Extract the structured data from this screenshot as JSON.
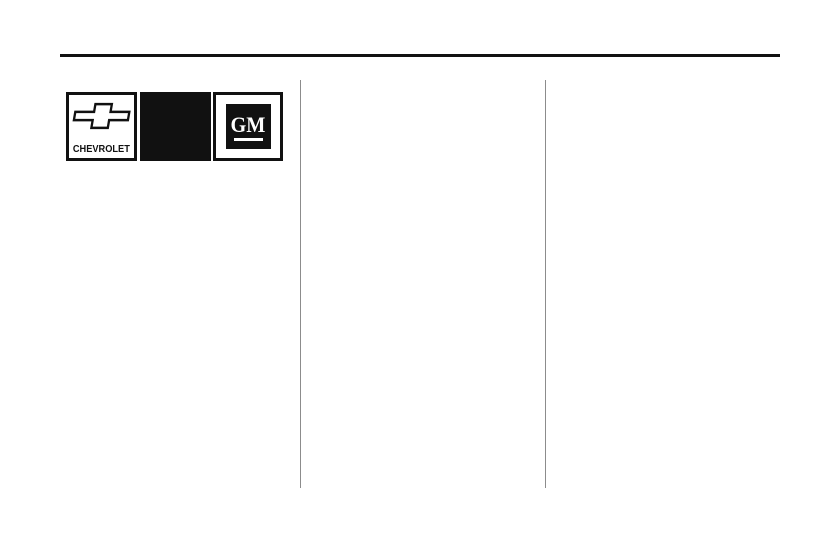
{
  "page": {
    "colors": {
      "background": "#ffffff",
      "rule": "#111111",
      "divider": "#8c8c8c",
      "logo-fg": "#111111",
      "logo-bg": "#ffffff"
    }
  },
  "logos": {
    "chevrolet": {
      "wordmark": "CHEVROLET"
    },
    "gm": {
      "monogram": "GM"
    }
  }
}
